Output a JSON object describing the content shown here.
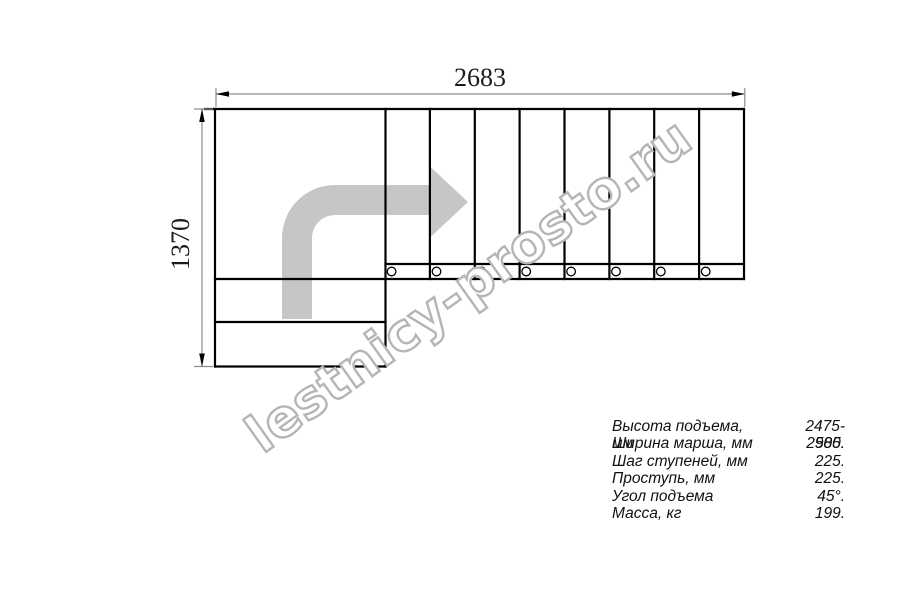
{
  "drawing": {
    "title": "stair-plan-top-view",
    "dimensions": {
      "width": "2683",
      "height": "1370"
    }
  },
  "watermark": {
    "text": "lestnicy-prosto.ru"
  },
  "specs": {
    "rows": [
      {
        "label": "Высота подъема, мм",
        "value": "2475-2585."
      },
      {
        "label": "Ширина марша, мм",
        "value": "900."
      },
      {
        "label": "Шаг ступеней, мм",
        "value": "225."
      },
      {
        "label": "Проступь, мм",
        "value": "225."
      },
      {
        "label": "Угол подъема",
        "value": "45°."
      },
      {
        "label": "Масса, кг",
        "value": "199."
      }
    ]
  },
  "colors": {
    "outline": "#000000",
    "dimension_line": "#8c8c8c",
    "direction_arrow": "#c6c6c6",
    "watermark_outline": "#b5b5b5",
    "background": "#ffffff"
  },
  "icons": {
    "direction_arrow": "curved-right-arrow",
    "fastener_hole": "small-circle"
  }
}
